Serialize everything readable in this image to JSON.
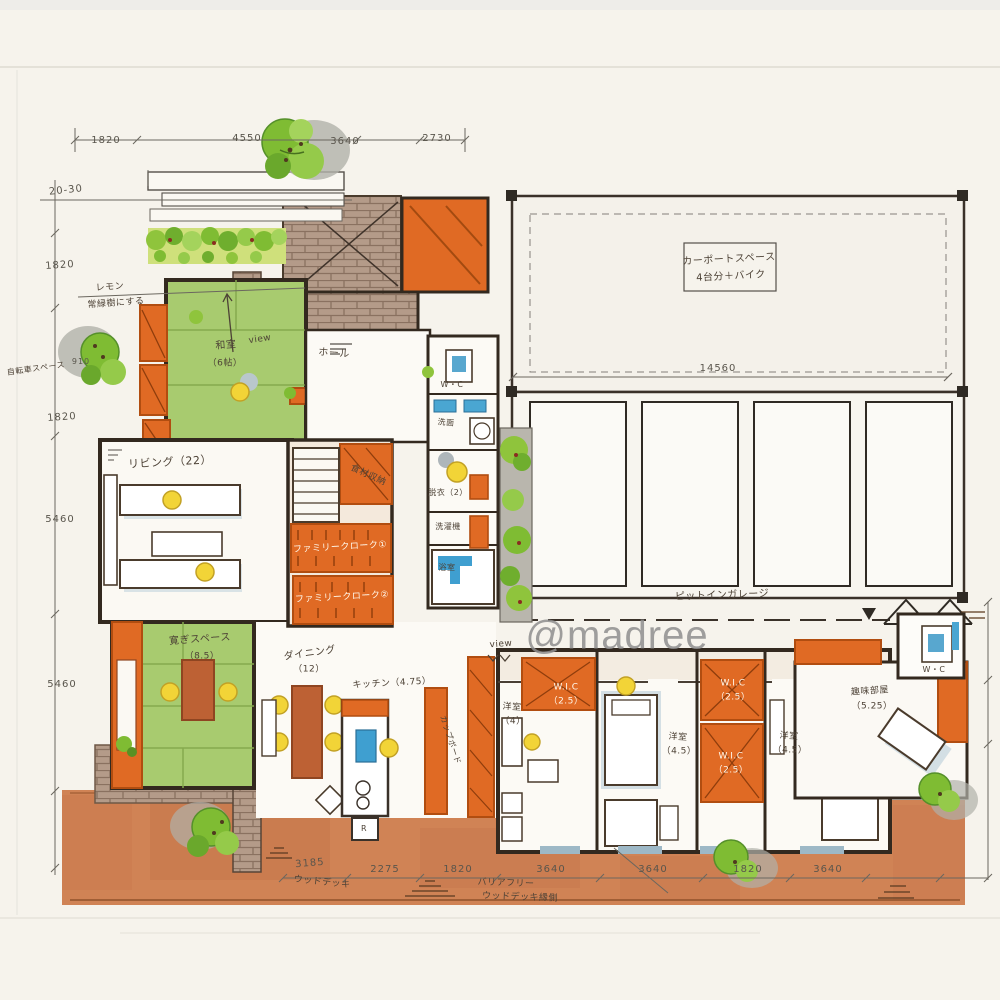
{
  "watermark": "@madree",
  "carport_box": {
    "line1": "カーポートスペース",
    "line2": "4台分＋バイク"
  },
  "dimensions": {
    "top": [
      "1820",
      "4550",
      "3640",
      "2730"
    ],
    "left": [
      "1820",
      "910",
      "1820",
      "5460",
      "5460"
    ],
    "bottom": [
      "3185",
      "2275",
      "1820",
      "3640",
      "3640",
      "1820",
      "3640"
    ],
    "garage_width": "14560",
    "setback_note": "20-30"
  },
  "rooms": {
    "washitsu": {
      "name": "和室",
      "size": "（6帖）"
    },
    "hall": "ホール",
    "living": "リビング（22）",
    "kutsurogi": {
      "name": "寛ぎスペース",
      "size": "（8.5）"
    },
    "dining": {
      "name": "ダイニング",
      "size": "（12）"
    },
    "kitchen": "キッチン（4.75）",
    "cupboard": "カップボード",
    "pantry": "食材収納",
    "family_cloak_1": "ファミリークローク①",
    "family_cloak_2": "ファミリークローク②",
    "wc_1": "W・C",
    "senmen": "洗面",
    "datsui": "脱衣（2）",
    "laundry": "洗濯機",
    "bath": "浴室",
    "bedroom_1": {
      "name": "洋室",
      "size": "（4）"
    },
    "wic_1": {
      "name": "W.I.C",
      "size": "（2.5）"
    },
    "bedroom_2": {
      "name": "洋室",
      "size": "（4.5）"
    },
    "wic_2": {
      "name": "W.I.C",
      "size": "（2.5）"
    },
    "wic_3": {
      "name": "W.I.C",
      "size": "（2.5）"
    },
    "bedroom_3": {
      "name": "洋室",
      "size": "（4.5）"
    },
    "hobby": {
      "name": "趣味部屋",
      "size": "（5.25）"
    },
    "wc_2": "W・C",
    "garage": "ピットインガレージ",
    "fridge": "R"
  },
  "notes": {
    "view_top": "view",
    "view_bottom": "view",
    "tree_note_1": "レモン",
    "tree_note_2": "常緑樹にする",
    "bike_space": "自転車スペース",
    "wood_deck": "ウッドデッキ",
    "deck_note_1": "バリアフリー",
    "deck_note_2": "ウッドデッキ縁側"
  },
  "colors": {
    "paper": "#f6f3ec",
    "wall_ink": "#33291f",
    "orange": "#e06a24",
    "tatami_green": "#a8cb6f",
    "tree_green": "#7fbc33",
    "brick": "#b49b89",
    "deck_terracotta": "#d08355",
    "water_blue": "#3f9fd0",
    "person_yellow": "#f2d437",
    "shadow_blue": "#b9cdd8",
    "watermark_gray": "#8f8f8f"
  }
}
